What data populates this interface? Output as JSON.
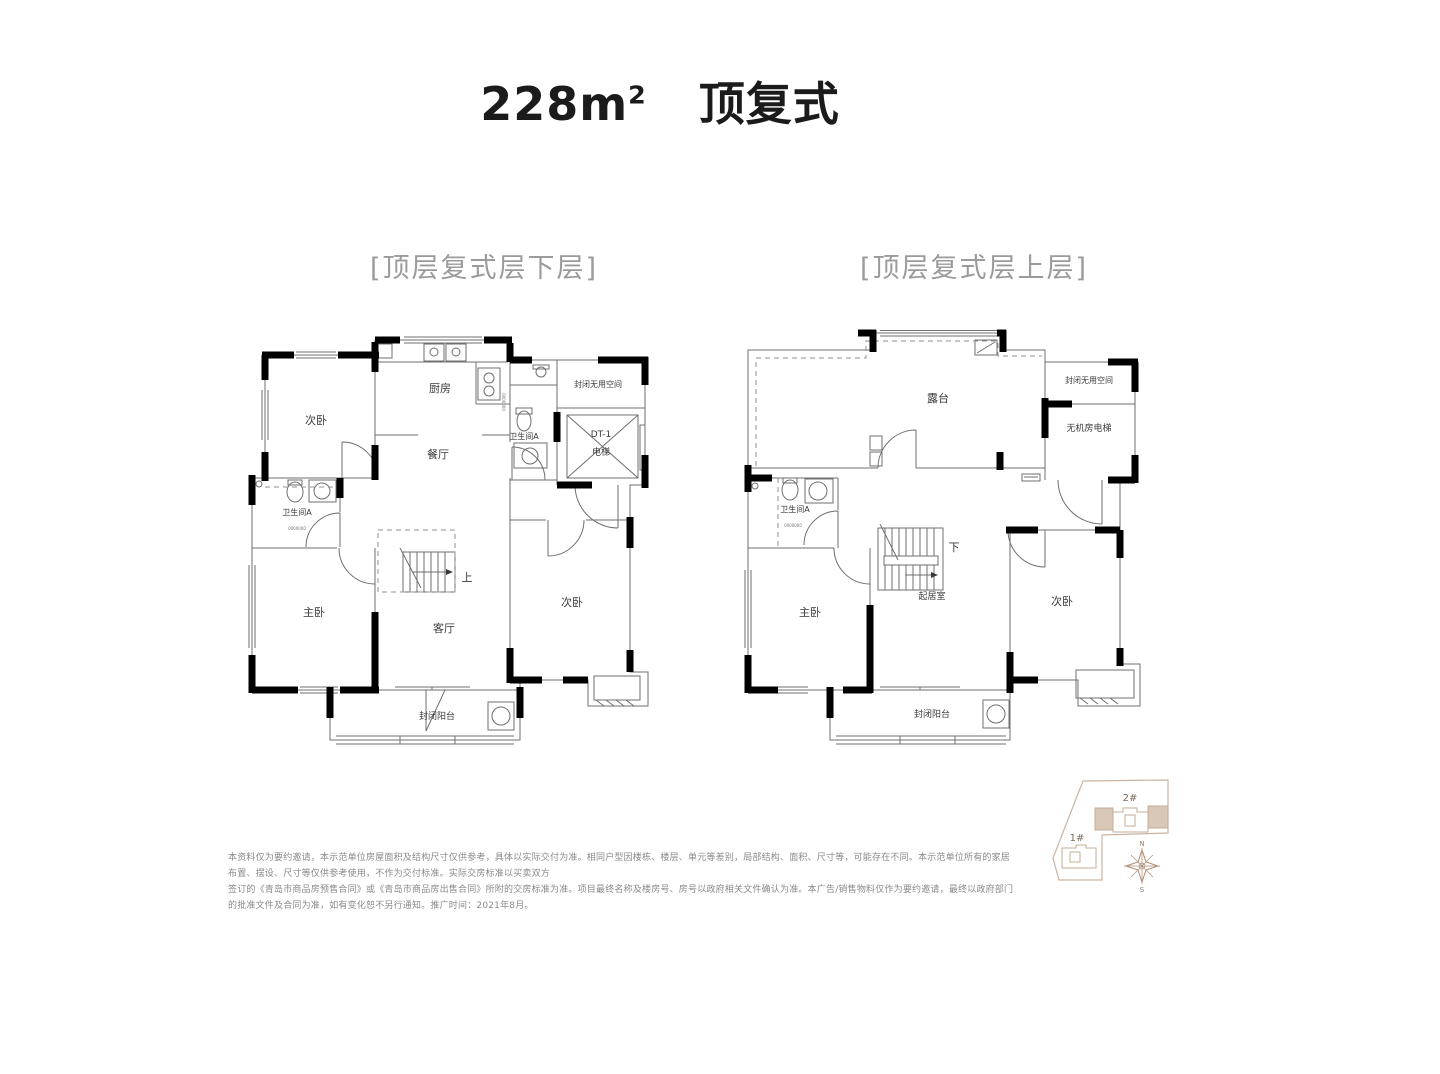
{
  "title": {
    "area_value": "228m",
    "area_sup": "2",
    "type_label": "顶复式"
  },
  "plan_lower": {
    "caption": "[顶层复式层下层]",
    "rooms": {
      "bedroom_top": "次卧",
      "kitchen": "厨房",
      "dining": "餐厅",
      "bath_right": "卫生间A",
      "sealed_void": "封闭无用空间",
      "elevator_code": "DT-1",
      "elevator": "电梯",
      "bath_left": "卫生间A",
      "master_bedroom": "主卧",
      "living": "客厅",
      "bedroom_bottom": "次卧",
      "balcony": "封闭阳台",
      "stair_dir": "上",
      "dim_mask_a": "0000000",
      "dim_mask_b": "0000000"
    }
  },
  "plan_upper": {
    "caption": "[顶层复式层上层]",
    "rooms": {
      "terrace": "露台",
      "sealed_void": "封闭无用空间",
      "elevator": "无机房电梯",
      "bath": "卫生间A",
      "master_bedroom": "主卧",
      "family_room": "起居室",
      "bedroom": "次卧",
      "balcony": "封闭阳台",
      "stair_dir": "下",
      "dim_mask": "0000000"
    }
  },
  "disclaimer": {
    "line1": "本资料仅为要约邀请，本示范单位房屋面积及结构尺寸仅供参考，具体以实际交付为准。相同户型因楼栋、楼层、单元等差别，局部结构、面积、尺寸等，可能存在不同。本示范单位所有的家居布置、摆设、尺寸等仅供参考使用，不作为交付标准。实际交房标准以买卖双方",
    "line2": "签订的《青岛市商品房预售合同》或《青岛市商品房出售合同》所附的交房标准为准。项目最终名称及楼房号、房号以政府相关文件确认为准。本广告/销售物料仅作为要约邀请，最终以政府部门的批准文件及合同为准，如有变化恕不另行通知。推广时间：2021年8月。"
  },
  "site_plan": {
    "building_1": "1#",
    "building_2": "2#",
    "compass_north": "N",
    "compass_south": "S"
  },
  "colors": {
    "wall": "#000000",
    "thin_line": "#6f6f6f",
    "room_text": "#3a3a3a",
    "caption_text": "#9b9b9b",
    "disclaimer_text": "#8a8a8a",
    "site_outline": "#c9b4a1",
    "site_building_fill": "#d9c8b8",
    "compass": "#b08e76"
  }
}
